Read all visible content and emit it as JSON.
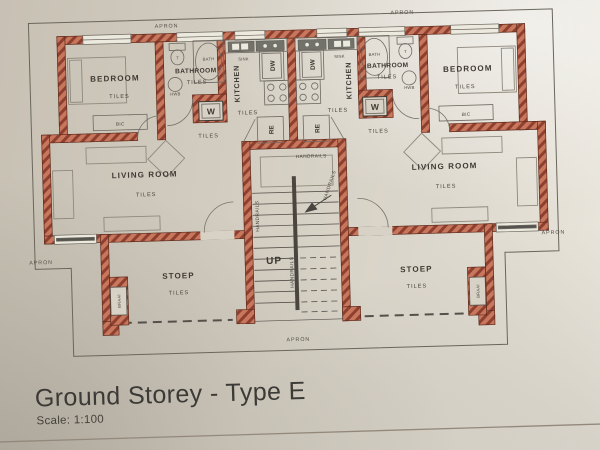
{
  "document": {
    "title": "Ground Storey - Type E",
    "scale": "Scale: 1:100"
  },
  "plan": {
    "room_labels": {
      "bedroom": "BEDROOM",
      "bathroom": "BATHROOM",
      "kitchen": "KITCHEN",
      "living_room": "LIVING ROOM",
      "stoep": "STOEP"
    },
    "floor_finish": "TILES",
    "exterior_label": "APRON",
    "fixture_labels": {
      "bath": "BATH",
      "toilet": "T",
      "hand_wash_basin": "HWB",
      "sink": "SINK",
      "washing_machine": "W",
      "dishwasher": "DW",
      "refrigerator": "RE",
      "built_in_cupboard": "BIC",
      "braai": "BRAAI"
    },
    "stair_labels": {
      "up": "UP",
      "handrails": "HANDRAILS"
    },
    "colors": {
      "wall_base": "#c8775c",
      "wall_hatch": "#8e4030",
      "paper": "#d8d2c6",
      "line": "#4a453f"
    }
  }
}
